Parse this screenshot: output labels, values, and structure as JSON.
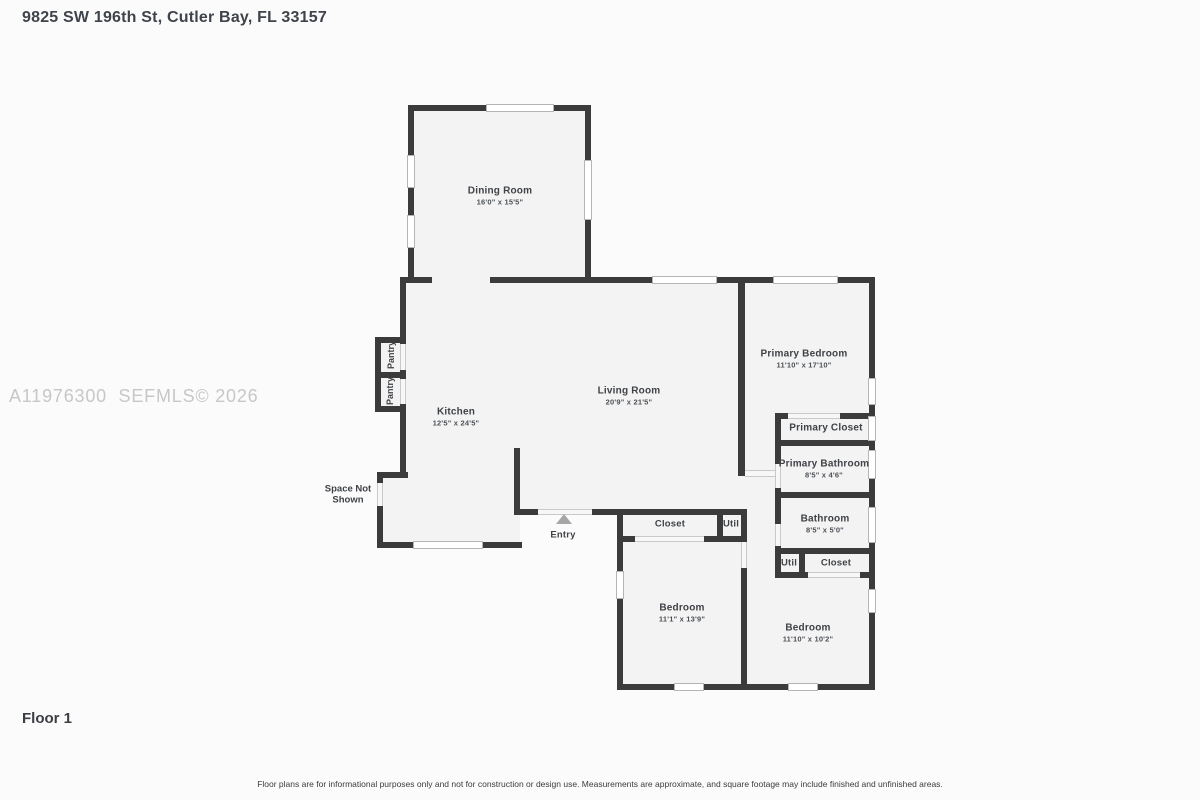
{
  "page": {
    "title": "9825 SW 196th St, Cutler Bay, FL 33157",
    "floor_label": "Floor 1",
    "watermark": "A11976300  SEFMLS© 2026",
    "disclaimer": "Floor plans are for informational purposes only and not for construction or design use. Measurements are approximate, and square footage may include finished and unfinished areas."
  },
  "rooms": {
    "dining": {
      "name": "Dining Room",
      "dims": "16'0\" x 15'5\""
    },
    "kitchen": {
      "name": "Kitchen",
      "dims": "12'5\" x 24'5\""
    },
    "living": {
      "name": "Living Room",
      "dims": "20'9\" x 21'5\""
    },
    "primary_bedroom": {
      "name": "Primary Bedroom",
      "dims": "11'10\" x 17'10\""
    },
    "primary_closet": {
      "name": "Primary Closet"
    },
    "primary_bathroom": {
      "name": "Primary Bathroom",
      "dims": "8'5\" x 4'6\""
    },
    "bathroom": {
      "name": "Bathroom",
      "dims": "8'5\" x 5'0\""
    },
    "bedroom_left": {
      "name": "Bedroom",
      "dims": "11'1\" x 13'9\""
    },
    "bedroom_right": {
      "name": "Bedroom",
      "dims": "11'10\" x 10'2\""
    },
    "closet_left": {
      "name": "Closet"
    },
    "util_left": {
      "name": "Util"
    },
    "util_right": {
      "name": "Util"
    },
    "closet_right": {
      "name": "Closet"
    },
    "pantry_top": {
      "name": "Pantry"
    },
    "pantry_bottom": {
      "name": "Pantry"
    },
    "space_not_shown": {
      "name": "Space Not\nShown"
    },
    "entry": {
      "name": "Entry"
    }
  },
  "colors": {
    "wall": "#3b3b3b",
    "floor": "#f3f3f3",
    "window": "#ffffff",
    "label_text": "#3f4246",
    "watermark": "#c7c7c7",
    "entry_marker": "#a6a6a6"
  }
}
